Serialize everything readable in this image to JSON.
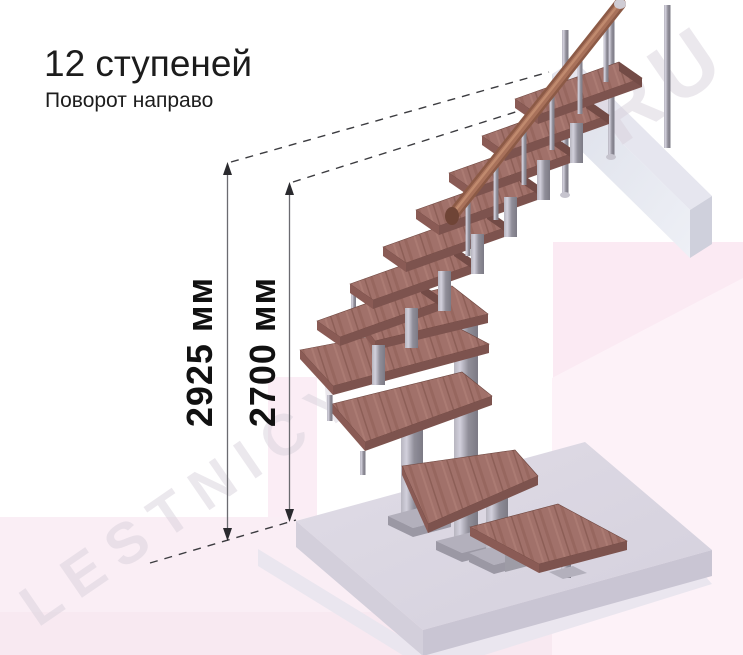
{
  "header": {
    "title": "12 ступеней",
    "subtitle": "Поворот направо"
  },
  "dimensions": {
    "overall_height_label": "2925 мм",
    "floor_height_label": "2700 мм"
  },
  "watermark": {
    "part1": "LESTNICY",
    "part2": "RU"
  },
  "stair": {
    "steps": "12",
    "turn_direction": "направо"
  },
  "colors": {
    "tread_wood": "#a1716a",
    "tread_edge": "#7d534e",
    "metal_post": "#908e99",
    "handrail_wood": "#8c5a46",
    "floor_slab": "#dbd7e2",
    "wall_panel": "#e0e2ec",
    "background_pink": "#faeef5",
    "dimension_text": "#111111"
  }
}
